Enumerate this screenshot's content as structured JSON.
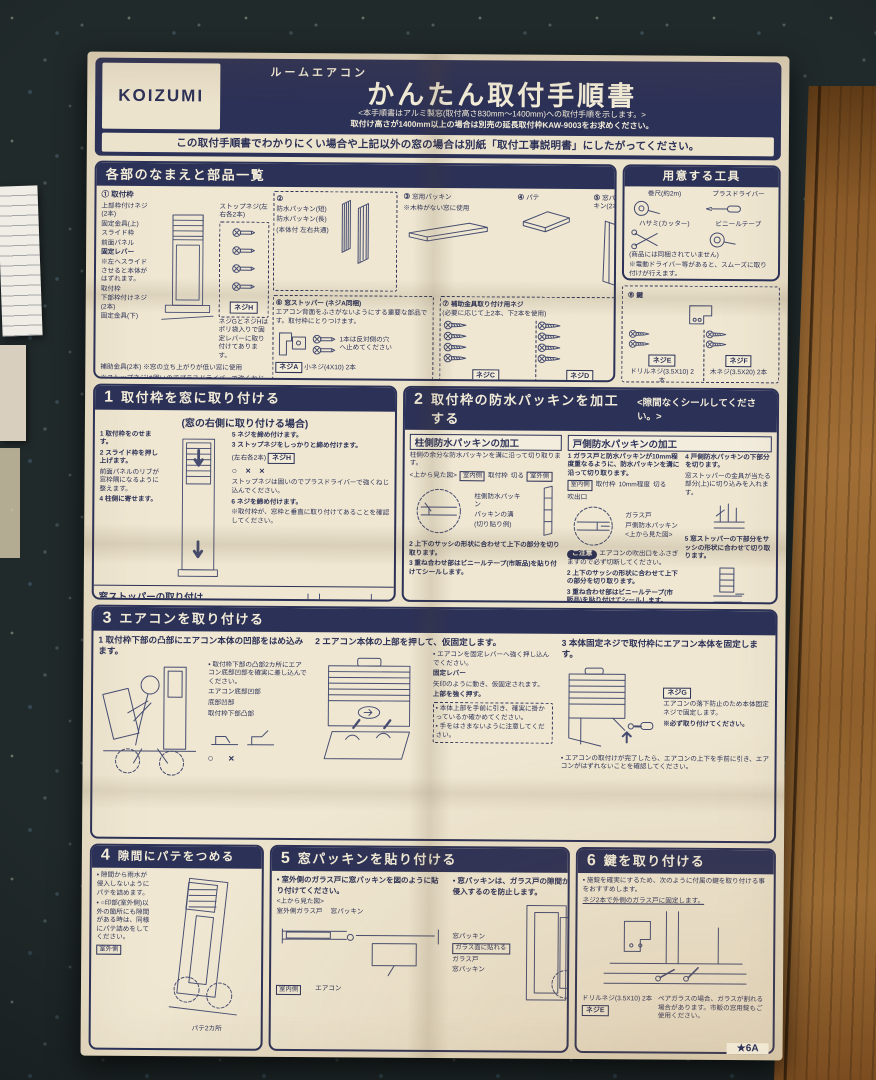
{
  "colors": {
    "navy": "#2c3157",
    "paper": "#ebe2cb",
    "wood": "#8a5a28"
  },
  "header": {
    "brand": "KOIZUMI",
    "product": "ルームエアコン",
    "title": "かんたん取付手順書",
    "sub1": "<本手順書はアルミ製窓(取付高さ830mm〜1400mm)への取付手順を示します。>",
    "sub2": "取付け高さが1400mm以上の場合は別売の延長取付枠KAW-9003をお求めください。",
    "notice": "この取付手順書でわかりにくい場合や上記以外の窓の場合は別紙「取付工事説明書」にしたがってください。"
  },
  "parts": {
    "title": "各部のなまえと部品一覧",
    "p1_num": "①",
    "p1_name": "取付枠",
    "p1_l1": "上部枠付けネジ(2本)",
    "p1_l2": "固定金具(上)",
    "p1_l3": "スライド枠",
    "p1_l4": "前面パネル",
    "p1_l5": "固定レバー",
    "p1_l5n": "※左へスライドさせると本体がはずれます。",
    "p1_l6": "ストップネジ(左右各2本)",
    "p1_l7": "取付枠",
    "p1_l8": "下部枠付けネジ(2本)",
    "p1_l9": "固定金具(下)",
    "p1_l10": "補助金具(2本)",
    "p1_l10n": "※窓の立ち上がりが低い窓に使用",
    "p1_tag": "ネジH",
    "p1_note1": "ネジGとネジHはポリ袋入りで固定レバーに取り付けてあります。",
    "p1_note2": "※ストップネジは固いのでプラスドライバーで強くねじ込んでください。",
    "p2_num": "②",
    "p2_a": "防水パッキン(短)",
    "p2_b": "防水パッキン(長)",
    "p2_n": "(本体付 左右共通)",
    "p3_num": "③",
    "p3_name": "窓用パッキン",
    "p3_n": "※木枠がない窓に使用",
    "p4_num": "④",
    "p4_name": "パテ",
    "p5_num": "⑤",
    "p5_name": "窓パッキン(2本)",
    "p6_num": "⑥",
    "p6_name": "窓ストッパー (ネジA同梱)",
    "p6_d": "エアコン背面をふさがないようにする重要な部品です。取付枠にとりつけます。",
    "p6_n": "1本は反対側の穴へ止めてください",
    "p6_tag": "ネジA",
    "p6_spec": "小ネジ(4X10) 2本",
    "p7_num": "⑦",
    "p7_name": "補助金具取り付け用ネジ",
    "p7_d": "(必要に応じて上2本、下2本を使用)",
    "p7_tag1": "ネジC",
    "p7_spec1": "木ネジ(4.1X20) 4本",
    "p7_tag2": "ネジD",
    "p7_spec2": "タッピングネジ(4X8) 4本",
    "p8_num": "⑧",
    "p8_name": "鍵",
    "p8_tag1": "ネジE",
    "p8_spec1": "ドリルネジ(3.5X10) 2本",
    "p8_tag2": "ネジF",
    "p8_spec2": "木ネジ(3.5X20) 2本"
  },
  "tools": {
    "title": "用意する工具",
    "items": [
      "巻尺(約2m)",
      "プラスドライバー",
      "ハサミ(カッター)",
      "ビニールテープ"
    ],
    "note1": "(商品には同梱されていません)",
    "note2": "※電動ドライバー等があると、スムーズに取り付けが行えます。"
  },
  "s1": {
    "num": "1",
    "title": "取付枠を窓に取り付ける",
    "subtitle": "(窓の右側に取り付ける場合)",
    "st1": "1 取付枠をのせます。",
    "st2": "2 スライド枠を押し上げます。",
    "st2b": "前面パネルのリブが窓枠隅になるように整えます。",
    "st4": "4 柱側に寄せます。",
    "st5": "5 ネジを締め付けます。",
    "st3": "3 ストップネジをしっかりと締め付けます。",
    "st3b": "(左右各2本)",
    "st3tag": "ネジH",
    "marks": "○ × ×",
    "note1": "ストップネジは固いのでプラスドライバーで強くねじ込んでください。",
    "st6": "6 ネジを締め付けます。",
    "note2": "※取付枠が、窓枠と垂直に取り付けてあることを確認してください。",
    "stp_title": "窓ストッパーの取り付け",
    "stp_b": "窓ストッパーを取付枠の左側に小ネジで取り付けます。",
    "stp_l1": "取付枠",
    "stp_l2": "窓ストッパー",
    "stp_l3": "小ネジ(4X10)",
    "stp_tag": "ネジA",
    "stp_note": "窓の左側に取り付ける場合は取付枠の右側に取り付けます。"
  },
  "s2": {
    "num": "2",
    "title": "取付枠の防水パッキンを加工する",
    "subtitle": "<隙間なくシールしてください。>",
    "lh": "柱側防水パッキンの加工",
    "li": "柱側の余分な防水パッキンを溝に沿って切り取ります。",
    "l_top": "<上から見た図>",
    "l_in": "室内側",
    "l_frame": "取付枠",
    "l_cut": "切る",
    "l_out": "室外側",
    "l_pk": "柱側防水パッキン",
    "l_groove": "パッキンの溝",
    "l_ex": "(切り貼り例)",
    "l2": "2 上下のサッシの形状に合わせて上下の部分を切り取ります。",
    "l3": "3 重ね合わせ部はビニールテープ(市販品)を貼り付けてシールします。",
    "rh": "戸側防水パッキンの加工",
    "r1": "1 ガラス戸と防水パッキンが10mm程度重なるように、防水パッキンを溝に沿って切り取ります。",
    "r_top": "<上から見た図>",
    "r_in": "室内側",
    "r_frame": "取付枠",
    "r_10": "10mm程度",
    "r_cut": "切る",
    "r_out": "吹出口",
    "r_door": "ガラス戸",
    "r_pk": "戸側防水パッキン",
    "caution_tag": "ご注意",
    "caution": "エアコンの吹出口をふさぎますので必ず切断してください。",
    "r2": "2 上下のサッシの形状に合わせて上下の部分を切り取ります。",
    "r3": "3 重ね合わせ部はビニールテープ(市販品)を貼り付けてシールします。",
    "r4": "4 戸側防水パッキンの下部分を切ります。",
    "r4b": "窓ストッパーの金具が当たる部分(上)に切り込みを入れます。",
    "r5": "5 窓ストッパーの下部分をサッシの形状に合わせて切り取ります。"
  },
  "s3": {
    "num": "3",
    "title": "エアコンを取り付ける",
    "c1s": "1 取付枠下部の凸部にエアコン本体の凹部をはめ込みます。",
    "c1b": "取付枠下部の凸部2カ所にエアコン底部凹部を確実に差し込んでください。",
    "c1l1": "エアコン底部凹部",
    "c1l2": "底部凹部",
    "c1l3": "取付枠下部凸部",
    "c1marks": "○ ×",
    "c2s": "2 エアコン本体の上部を押して、仮固定します。",
    "c2b": "エアコンを固定レバーへ強く押し込んでください。",
    "c2lever": "固定レバー",
    "c2lever2": "矢印のように動き、仮固定されます。",
    "c2push": "上部を強く押す。",
    "c2n1": "本体上部を手前に引き、確実に掛かっているか確かめてください。",
    "c2n2": "手をはさまないように注意してください。",
    "c3s": "3 本体固定ネジで取付枠にエアコン本体を固定します。",
    "c3tag": "ネジG",
    "c3n1": "エアコンの落下防止のため本体固定ネジで固定します。",
    "c3n2": "※必ず取り付けてください。",
    "c3b": "エアコンの取付けが完了したら、エアコンの上下を手前に引き、エアコンがはずれないことを確認してください。"
  },
  "s4": {
    "num": "4",
    "title": "隙間にパテをつめる",
    "b1": "隙間から雨水が侵入しないようにパテを詰めます。",
    "b2": "○印部(室外側)以外の箇所にも隙間がある時は、同様にパテ詰めをしてください。",
    "l1": "室外側",
    "l2": "パテ2カ所"
  },
  "s5": {
    "num": "5",
    "title": "窓パッキンを貼り付ける",
    "b1": "室外側のガラス戸に窓パッキンを図のように貼り付けてください。",
    "l_top": "<上から見た図>",
    "l1": "室外側ガラス戸",
    "l2": "窓パッキン",
    "l3": "室内側",
    "l4": "エアコン",
    "b2": "窓パッキンは、ガラス戸の隙間から外気や虫などが侵入するのを防止します。",
    "r1": "窓パッキン",
    "r2": "ガラス面に貼れる",
    "r3": "ガラス戸",
    "r4": "窓パッキン",
    "r5": "ガラス戸の形状に合わせて切る",
    "r6": "室外側"
  },
  "s6": {
    "num": "6",
    "title": "鍵を取り付ける",
    "b1": "施錠を確実にするため、次のように付属の鍵を取り付ける事をおすすめします。",
    "n1": "ネジ2本で外側のガラス戸に固定します。",
    "spec": "ドリルネジ(3.5X10) 2本",
    "tag": "ネジE",
    "caution": "ペアガラスの場合、ガラスが割れる場合があります。市販の窓用錠もご使用ください。"
  },
  "footer": {
    "mark": "★6A"
  }
}
